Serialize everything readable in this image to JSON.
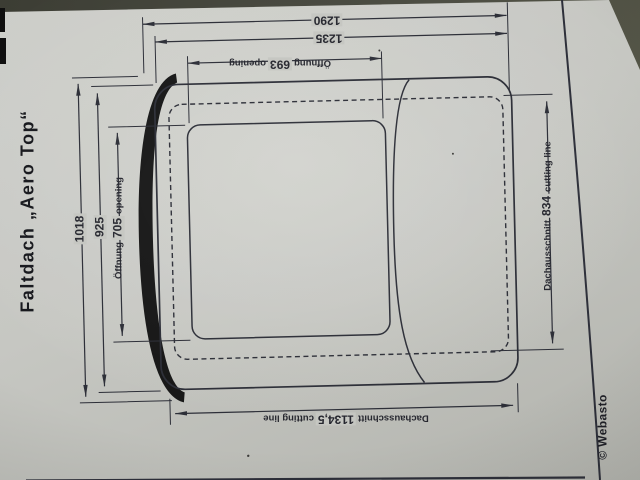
{
  "title": "Faltdach „Aero Top“",
  "credit": "© Webasto",
  "dims": {
    "d1290": {
      "value": "1290"
    },
    "d1235": {
      "value": "1235"
    },
    "d693": {
      "de": "Öffnung",
      "value": "693",
      "en": "opening"
    },
    "d1018": {
      "value": "1018"
    },
    "d925": {
      "value": "925"
    },
    "d705": {
      "de": "Öffnung",
      "value": "705",
      "en": "opening"
    },
    "d834": {
      "de": "Dachausschnitt",
      "value": "834",
      "en": "cutting line"
    },
    "d1134": {
      "de": "Dachausschnitt",
      "value": "1134,5",
      "en": "cutting line"
    }
  },
  "colors": {
    "paper": "#c7c8c3",
    "background": "#46473d",
    "ink": "#2a2c36",
    "band": "#141414"
  }
}
